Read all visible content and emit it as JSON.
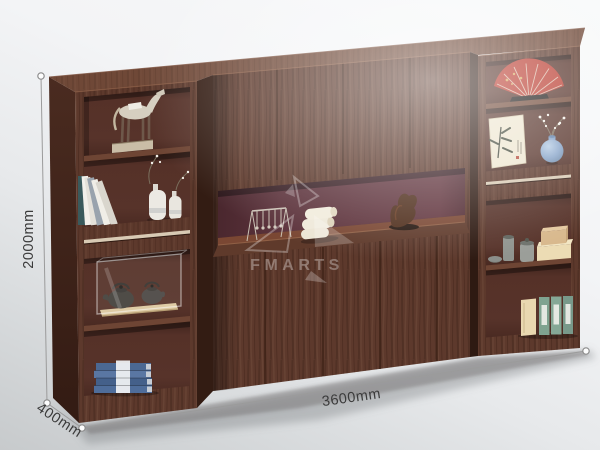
{
  "dimensions": {
    "height_label": "2000mm",
    "width_label": "3600mm",
    "depth_label": "400mm"
  },
  "watermark": {
    "brand": "FMARTS"
  },
  "colors": {
    "background_top": "#f8f9fa",
    "background_bottom": "#c7cacc",
    "wood_front": "#5d392c",
    "wood_grain_dark": "#4a2a1f",
    "wood_top_face": "#6f4837",
    "wood_side_face": "#40251c",
    "interior_back": "#533027",
    "niche_back_maroon": "#5c333c",
    "aluminum_strip": "#d8cab4",
    "dimension_line": "#9b9b9b",
    "dimension_label": "#3b3b3b",
    "watermark_white": "#ffffff",
    "fan_red": "#b93a2e",
    "vase_blue": "#7f9ec7",
    "book_stack_blue": "#4f6d9a",
    "binder_green": "#7fa390",
    "box_cream": "#ecdcb4",
    "towel_white": "#efe9da",
    "statue_champagne": "#d6cfc0"
  },
  "decor": {
    "left_column": [
      "horse-statue",
      "leaning-books",
      "ceramic-vases",
      "teapot-display-case",
      "blue-book-stack"
    ],
    "center_niche": [
      "wire-ornament",
      "rolled-towels",
      "abstract-sculpture"
    ],
    "right_column": [
      "red-folding-fan",
      "ink-painting-card",
      "blossom-vase",
      "tea-set",
      "stacked-boxes",
      "green-binders"
    ]
  }
}
